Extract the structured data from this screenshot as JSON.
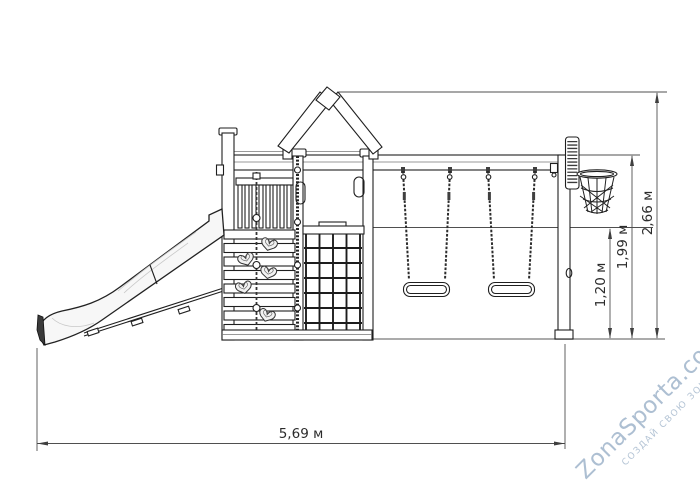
{
  "diagram": {
    "type": "technical side-view drawing of a children playground complex",
    "components": [
      "slide",
      "climbing ramp",
      "climbing wall with heart holds",
      "knotted rope",
      "tower with gable roof",
      "climbing net",
      "swing beam",
      "two swings",
      "basketball backboard with net hoop"
    ],
    "dimension_labels": {
      "total_width": "5,69 м",
      "total_height": "2,66 м",
      "beam_height": "1,99 м",
      "lower_height": "1,20 м"
    },
    "colors": {
      "outline": "#1f1f1f",
      "dimension_lines": "#4f4f4f",
      "ground_line": "#8f8f8f",
      "label_text": "#2b2b2b",
      "slide_fill": "#f7f7f7",
      "watermark": "#86a0bc"
    }
  },
  "watermark": {
    "brand": "ZonaSporta.com",
    "slogan": "СОЗДАЙ СВОЮ ЗОНУ СПОРТА"
  }
}
